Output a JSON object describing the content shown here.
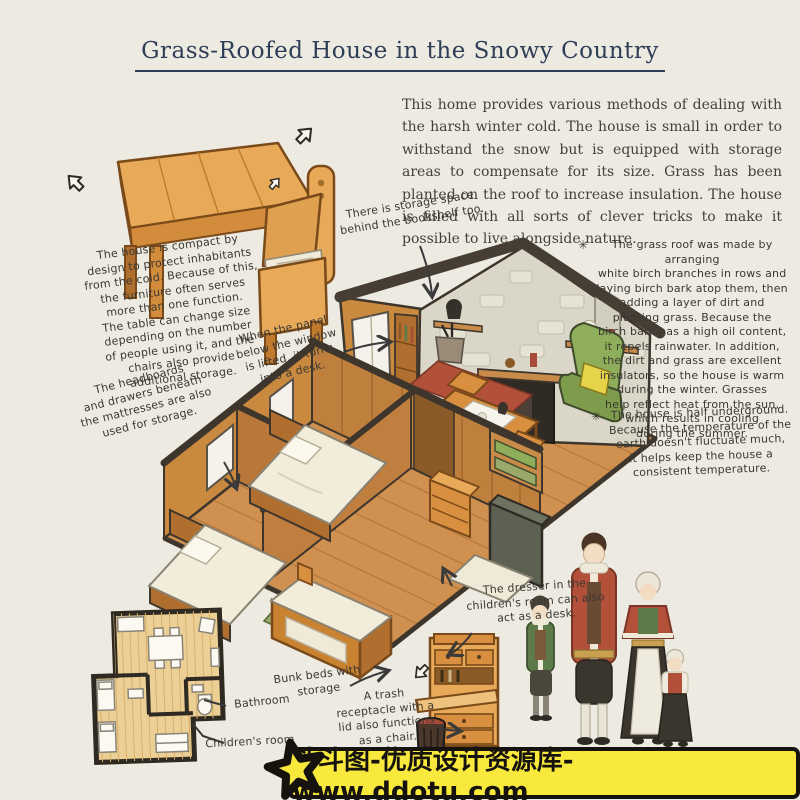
{
  "title": "Grass-Roofed House in the Snowy Country",
  "intro": "This home provides various methods of dealing with the harsh winter cold. The house is small in order to withstand the snow but is equipped with storage areas to compensate for its size. Grass has been planted on the roof to increase insulation. The house is filled with all sorts of clever tricks to make it possible to live alongside nature.",
  "annotations": {
    "bookshelf": "There is storage space\nbehind the bookshelf too.",
    "panel_desk": "When the panel\nbelow the window\nis lifted, it turns\ninto a desk.",
    "multifunction_furniture": "The house is compact by\ndesign to protect inhabitants\nfrom the cold. Because of this,\nthe furniture often serves\nmore than one function.\nThe table can change size\ndepending on the number\nof people using it, and the\nchairs also provide\nadditional storage.",
    "grass_roof_marker": "✳",
    "grass_roof": "The grass roof was made by arranging\nwhite birch branches in rows and\nlaying birch bark atop them, then\nadding a layer of dirt and\nplanting grass. Because the\nbirch bark has a high oil content,\nit repels rainwater. In addition,\nthe dirt and grass are excellent\ninsulators, so the house is warm\nduring the winter. Grasses\nhelp reflect heat from the sun,\nwhich results in cooling\nduring the summer.",
    "underground_marker": "✳",
    "underground": "The house is half underground.\nBecause the temperature of the\nearth doesn't fluctuate much,\nit helps keep the house a\nconsistent temperature.",
    "headboards": "The headboards\nand drawers beneath\nthe mattresses are also\nused for storage.",
    "dresser_desk": "The dresser in the\nchildren's room can also\nact as a desk.",
    "bunk_beds": "Bunk beds with\nstorage",
    "trash_chair": "A trash\nreceptacle with a\nlid also functions\nas a chair."
  },
  "floor_plan": {
    "bathroom": "Bathroom",
    "childrens_room": "Children's room"
  },
  "watermark": {
    "text": "斗斗图-优质设计资源库-www.ddotu.com",
    "banner_color": "#f8e93c",
    "border_color": "#16130f"
  },
  "colors": {
    "background": "#edeae1",
    "title_navy": "#2f3e57",
    "body_text": "#44403a",
    "wood_light": "#e8aa58",
    "wood_mid": "#cf9050",
    "wood_dark": "#b06f2e",
    "roof_dark": "#463e35",
    "stone": "#dbd7c8",
    "armchair_green": "#8fae5b",
    "cushion_yellow": "#e5d44a",
    "rug_red": "#b2503a",
    "coat_red": "#b2503a",
    "coat_green": "#5d7a4a"
  }
}
